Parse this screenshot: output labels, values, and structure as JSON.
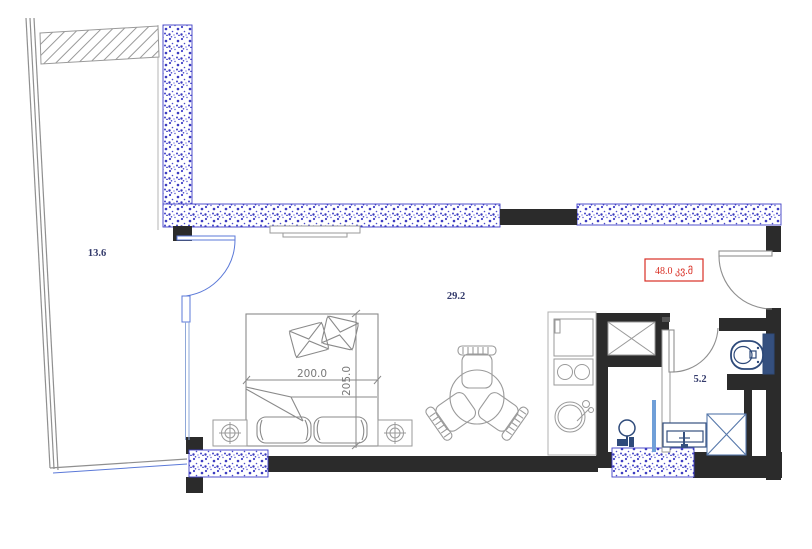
{
  "plan": {
    "rooms": {
      "balcony": {
        "area": "13.6"
      },
      "living_room": {
        "area": "29.2"
      },
      "bathroom": {
        "area": "5.2"
      }
    },
    "total_area_badge": "48.0 კვ.მ",
    "bed_dimensions": {
      "width": "200.0",
      "depth": "205.0"
    },
    "colors": {
      "wall_fill": "#2b2b2b",
      "masonry_speckle_blue": "#4040c6",
      "fixture_navy": "#2e4a7a",
      "badge_red": "#d93025",
      "furniture_gray": "#9a9a9a",
      "label_navy": "#333a6b",
      "glass_blue": "#6f9fd8"
    }
  }
}
